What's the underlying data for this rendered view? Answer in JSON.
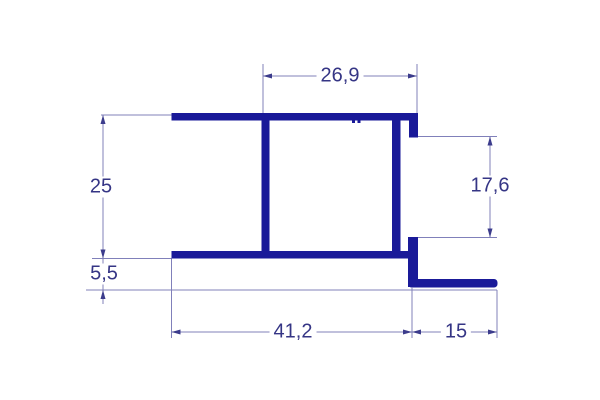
{
  "drawing": {
    "description": "technical cross-section drawing of an aluminum profile with dimension lines",
    "colors": {
      "profile": "#1a1a99",
      "dimension_line": "#8080ba",
      "arrow": "#3c3c8c",
      "label_text": "#353585",
      "background": "#ffffff"
    },
    "dimensions": {
      "top_width": "26,9",
      "left_height": "25",
      "right_opening": "17,6",
      "bottom_offset": "5,5",
      "bottom_width": "41,2",
      "flange_width": "15"
    }
  }
}
